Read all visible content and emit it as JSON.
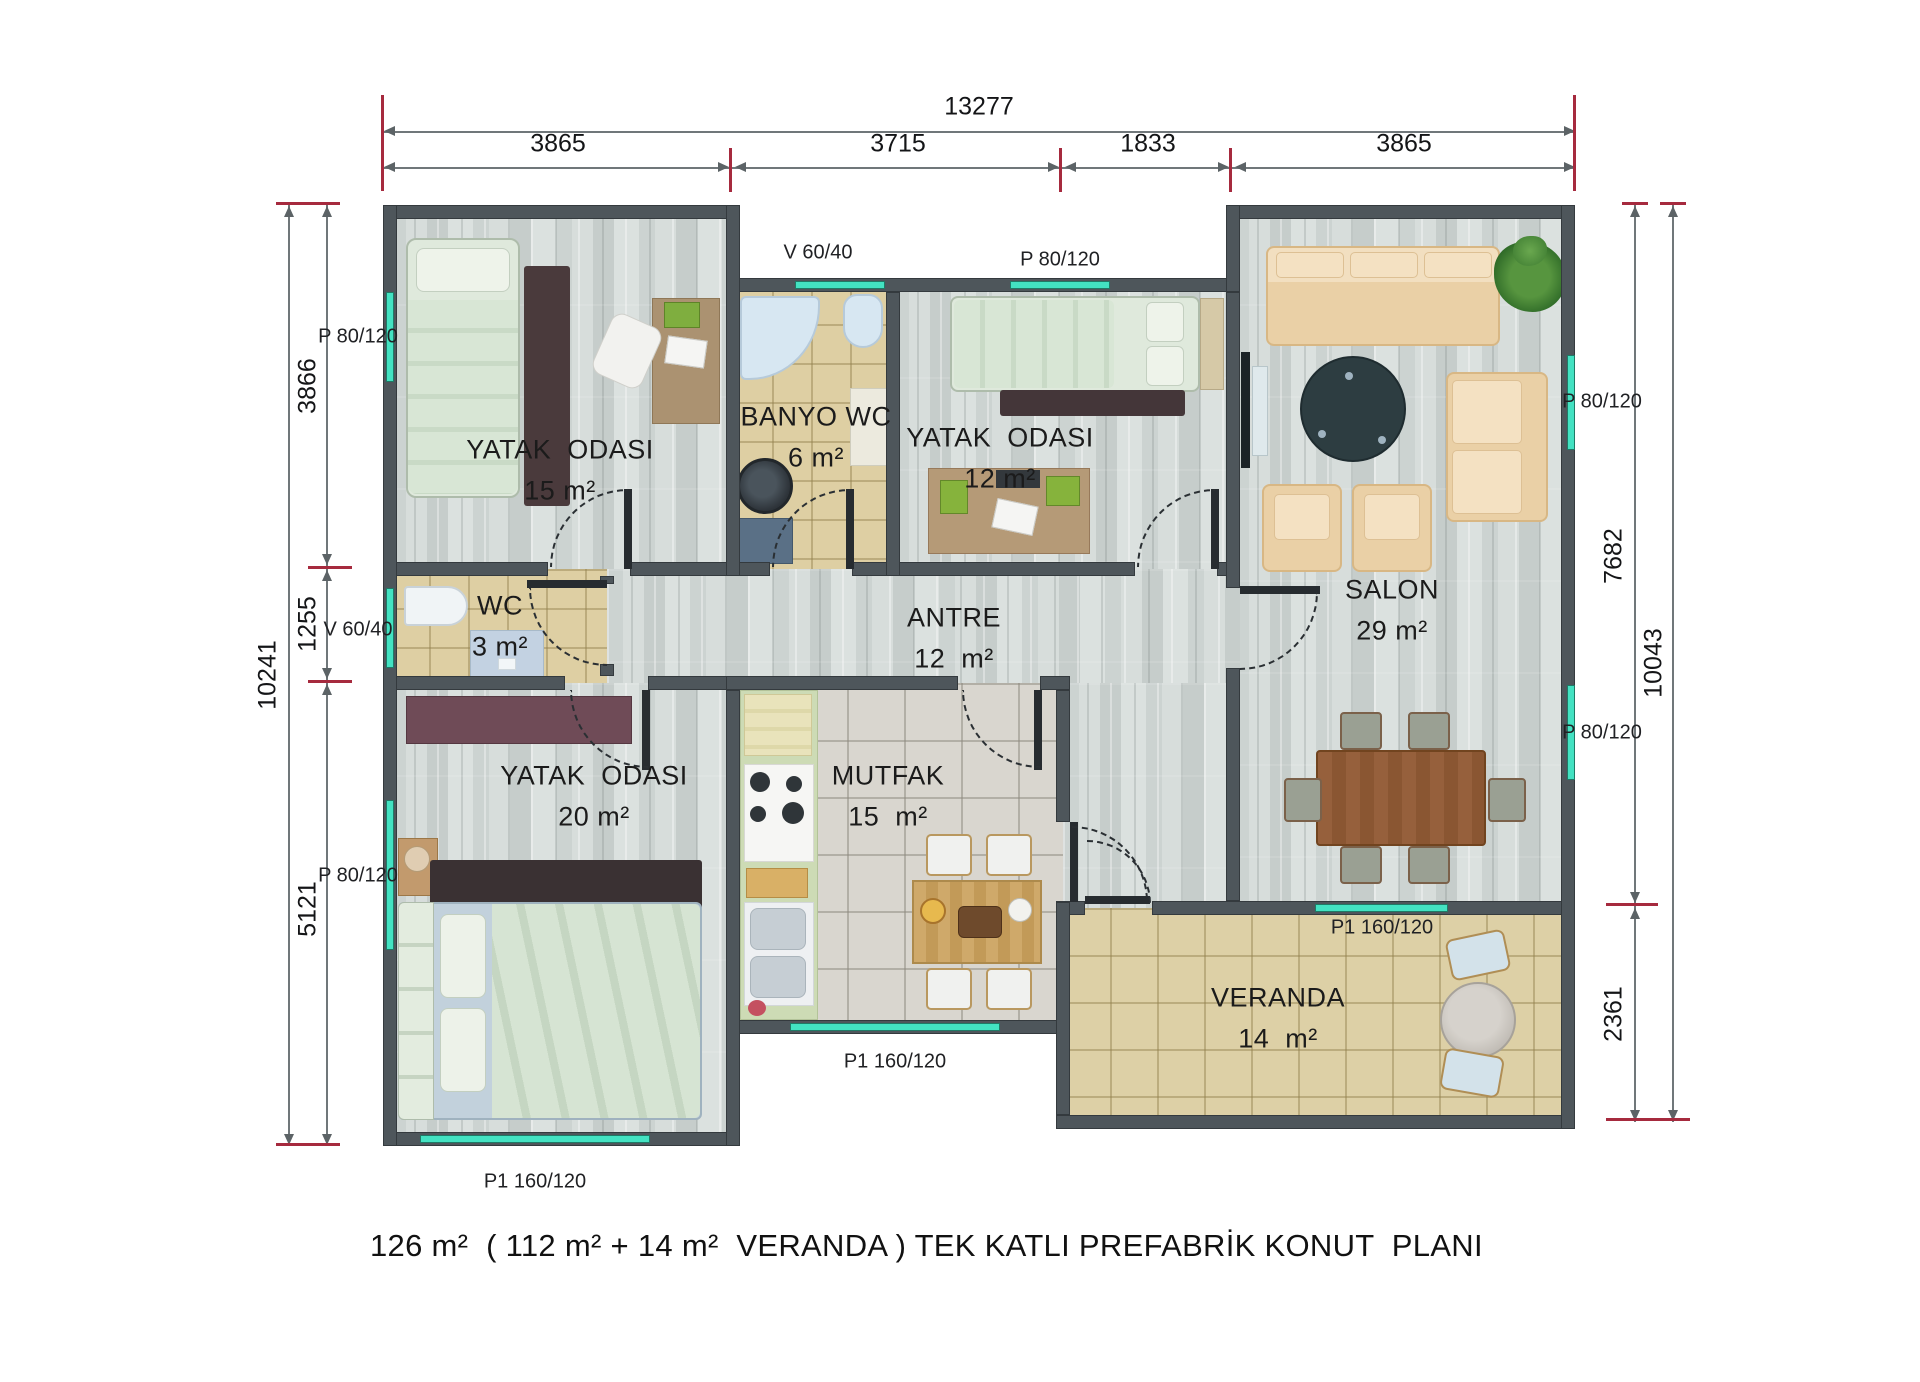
{
  "title": "126 m²  ( 112 m² + 14 m²  VERANDA ) TEK KATLI PREFABRİK KONUT  PLANI",
  "dims": {
    "top_total": "13277",
    "top_s1": "3865",
    "top_s2": "3715",
    "top_s3": "1833",
    "top_s4": "3865",
    "left_total": "10241",
    "left_s1": "3866",
    "left_s2": "1255",
    "left_s3": "5121",
    "right_total": "10043",
    "right_s1": "7682",
    "right_s2": "2361"
  },
  "rooms": {
    "bedroom1": {
      "name": "YATAK  ODASI",
      "area": "15 m²"
    },
    "bathroom": {
      "name": "BANYO WC",
      "area": "6 m²"
    },
    "bedroom2": {
      "name": "YATAK  ODASI",
      "area": "12 m²"
    },
    "salon": {
      "name": "SALON",
      "area": "29 m²"
    },
    "wc": {
      "name": "WC",
      "area": "3 m²"
    },
    "hall": {
      "name": "ANTRE",
      "area": "12  m²"
    },
    "bedroom3": {
      "name": "YATAK  ODASI",
      "area": "20 m²"
    },
    "kitchen": {
      "name": "MUTFAK",
      "area": "15  m²"
    },
    "veranda": {
      "name": "VERANDA",
      "area": "14  m²"
    }
  },
  "openings": {
    "w_bed1_left": "P 80/120",
    "w_wc_left": "V 60/40",
    "w_bed3_left": "P 80/120",
    "w_bath_top": "V 60/40",
    "w_bed2_top": "P 80/120",
    "w_salon_right_upper": "P 80/120",
    "w_salon_right_lower": "P 80/120",
    "w_bed3_bottom": "P1 160/120",
    "w_kitchen_bottom": "P1 160/120",
    "w_veranda_top": "P1 160/120"
  },
  "colors": {
    "window_accent": "#43E2C2",
    "wall": "#4E565B",
    "dim_tick_red": "#A62A3E",
    "floor_wood": "#D2D8D6",
    "floor_tile_tan": "#DECFA3",
    "floor_tile_kitchen": "#D9D6CF"
  }
}
